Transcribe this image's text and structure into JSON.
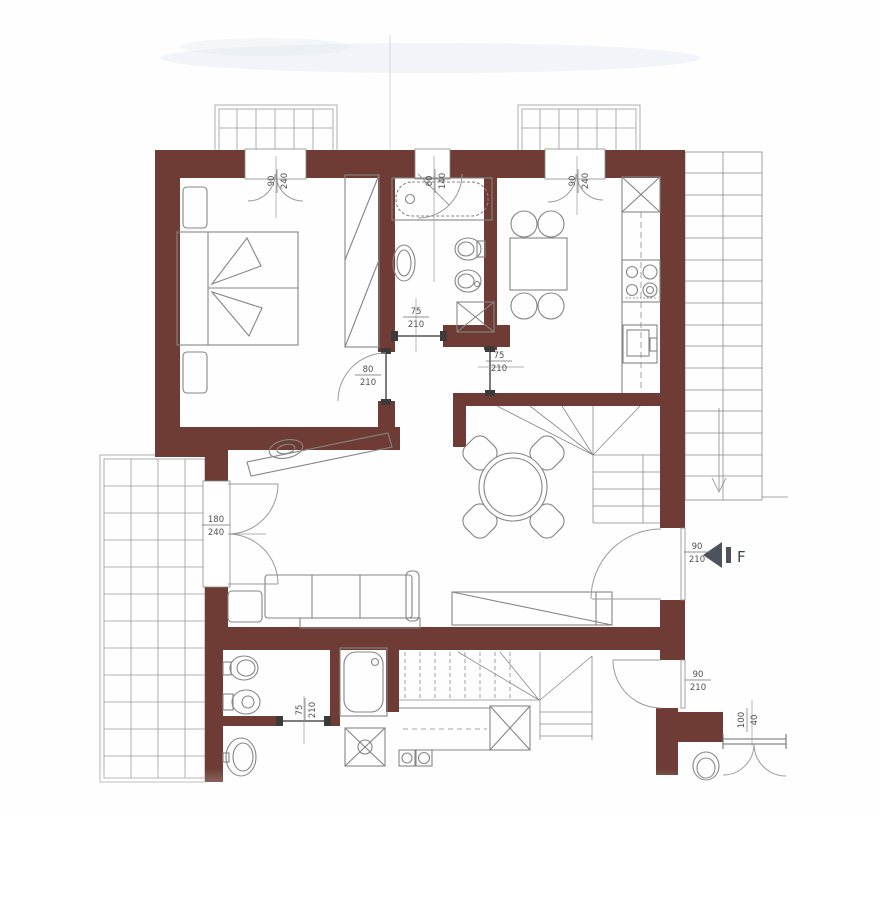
{
  "document": {
    "kind": "scanned apartment floor plan"
  },
  "colors": {
    "wall": "#6e3c34",
    "line": "#6f6f6f",
    "grid_line": "#9b9b9b",
    "label_text": "#4f4f4f",
    "entrance_marker": "#4d535c",
    "smudge": "#dfe7f0"
  },
  "entrance": {
    "letter": "F"
  },
  "dimensions": {
    "bedroom_window": {
      "width": "90",
      "height": "240"
    },
    "bathroom_window": {
      "width": "60",
      "height": "140"
    },
    "kitchen_window": {
      "width": "90",
      "height": "240"
    },
    "bathroom_door": {
      "width": "75",
      "height": "210"
    },
    "bedroom_door": {
      "width": "80",
      "height": "210"
    },
    "kitchen_door": {
      "width": "75",
      "height": "210"
    },
    "terrace_door": {
      "width": "180",
      "height": "240"
    },
    "entrance_door": {
      "width": "90",
      "height": "210"
    },
    "lower_door": {
      "width": "90",
      "height": "210"
    },
    "lower_bathroom_door": {
      "width": "75",
      "height": "210"
    },
    "lower_window": {
      "width": "100",
      "height": "40"
    }
  }
}
